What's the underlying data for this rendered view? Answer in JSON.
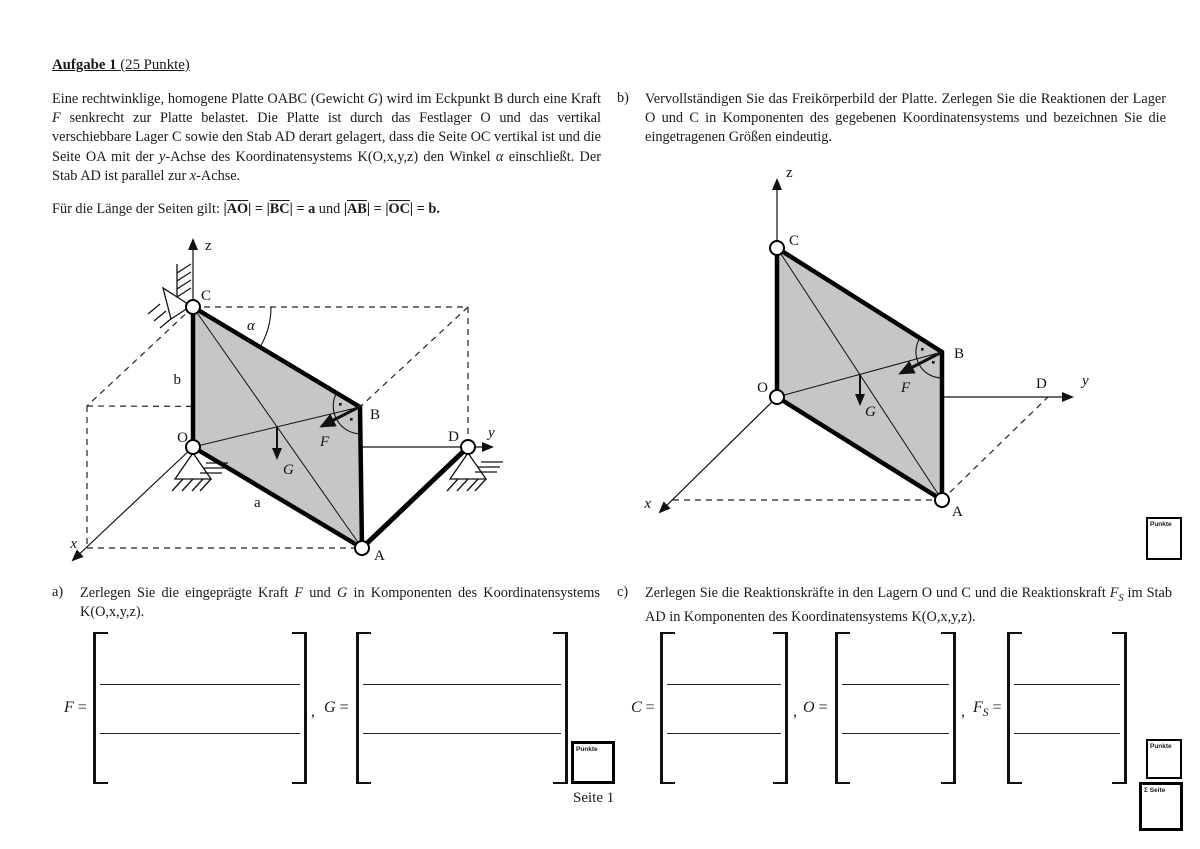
{
  "colors": {
    "plate_fill": "#c6c6c6",
    "ink": "#111111"
  },
  "heading": {
    "segments": [
      {
        "t": "Aufgabe 1",
        "b": 1
      },
      {
        "t": " (25 Punkte)"
      }
    ]
  },
  "intro": {
    "segments": [
      {
        "t": "Eine rechtwinklige, homogene Platte OABC (Gewicht "
      },
      {
        "t": "G",
        "i": 1
      },
      {
        "t": ") wird im Eckpunkt B durch eine Kraft "
      },
      {
        "t": "F",
        "i": 1
      },
      {
        "t": " senkrecht zur Platte belastet. Die Platte ist durch das Festlager O und das vertikal verschiebbare Lager C sowie den Stab AD derart gelagert, dass die Seite OC vertikal ist und die Seite OA mit der "
      },
      {
        "t": "y",
        "i": 1
      },
      {
        "t": "-Achse des Koordinatensystems K(O,x,y,z) den Winkel "
      },
      {
        "t": "α",
        "i": 1
      },
      {
        "t": " einschließt. Der Stab AD ist parallel zur "
      },
      {
        "t": "x",
        "i": 1
      },
      {
        "t": "-Achse."
      }
    ]
  },
  "lengths": {
    "segments": [
      {
        "t": "Für die Länge der Seiten gilt: "
      },
      {
        "t": "|",
        "b": 1
      },
      {
        "t": "AO",
        "b": 1,
        "o": 1
      },
      {
        "t": "|",
        "b": 1
      },
      {
        "t": " = ",
        "b": 1
      },
      {
        "t": "|",
        "b": 1
      },
      {
        "t": "BC",
        "b": 1,
        "o": 1
      },
      {
        "t": "|",
        "b": 1
      },
      {
        "t": " = a",
        "b": 1
      },
      {
        "t": " und "
      },
      {
        "t": "|",
        "b": 1
      },
      {
        "t": "AB",
        "b": 1,
        "o": 1
      },
      {
        "t": "|",
        "b": 1
      },
      {
        "t": " = ",
        "b": 1
      },
      {
        "t": "|",
        "b": 1
      },
      {
        "t": "OC",
        "b": 1,
        "o": 1
      },
      {
        "t": "|",
        "b": 1
      },
      {
        "t": " = b.",
        "b": 1
      }
    ]
  },
  "tasks": {
    "a": {
      "label": "a)",
      "segments": [
        {
          "t": "Zerlegen Sie die eingeprägte Kraft "
        },
        {
          "t": "F",
          "i": 1
        },
        {
          "t": " und "
        },
        {
          "t": "G",
          "i": 1
        },
        {
          "t": " in Komponenten des Koordinatensystems K(O,x,y,z)."
        }
      ]
    },
    "b": {
      "label": "b)",
      "text": "Vervollständigen Sie das Freikörperbild der Platte. Zerlegen Sie die Reaktionen der Lager O und C in Komponenten des gegebenen Koordinatensystems und bezeichnen Sie die eingetragenen Größen eindeutig."
    },
    "c": {
      "label": "c)",
      "segments": [
        {
          "t": "Zerlegen Sie die Reaktionskräfte in den Lagern O und C und die Reaktionskraft "
        },
        {
          "t": "F",
          "i": 1
        },
        {
          "t": "S",
          "i": 1,
          "sub": 1
        },
        {
          "t": " im Stab AD in Komponenten des Koordinatensystems K(O,x,y,z)."
        }
      ]
    }
  },
  "matrices": {
    "F": {
      "segments": [
        {
          "t": "F",
          "i": 1
        },
        {
          "t": " ="
        }
      ]
    },
    "G": {
      "segments": [
        {
          "t": "G",
          "i": 1
        },
        {
          "t": " ="
        }
      ]
    },
    "C": {
      "segments": [
        {
          "t": "C",
          "i": 1
        },
        {
          "t": " ="
        }
      ]
    },
    "O": {
      "segments": [
        {
          "t": "O",
          "i": 1
        },
        {
          "t": " ="
        }
      ]
    },
    "Fs": {
      "segments": [
        {
          "t": "F",
          "i": 1
        },
        {
          "t": "S",
          "i": 1,
          "sub": 1
        },
        {
          "t": " ="
        }
      ]
    },
    "separator": ","
  },
  "boxes": {
    "punkte": "Punkte",
    "sum_seite": "Σ Seite"
  },
  "footer": {
    "page_label": "Seite 1"
  },
  "diagram_left": {
    "labels": {
      "O": "O",
      "A": "A",
      "B": "B",
      "C": "C",
      "D": "D",
      "x": "x",
      "y": "y",
      "z": "z",
      "alpha": "α",
      "a": "a",
      "b": "b",
      "F": "F",
      "G": "G"
    }
  },
  "diagram_right": {
    "labels": {
      "O": "O",
      "A": "A",
      "B": "B",
      "C": "C",
      "D": "D",
      "x": "x",
      "y": "y",
      "z": "z",
      "F": "F",
      "G": "G"
    }
  }
}
